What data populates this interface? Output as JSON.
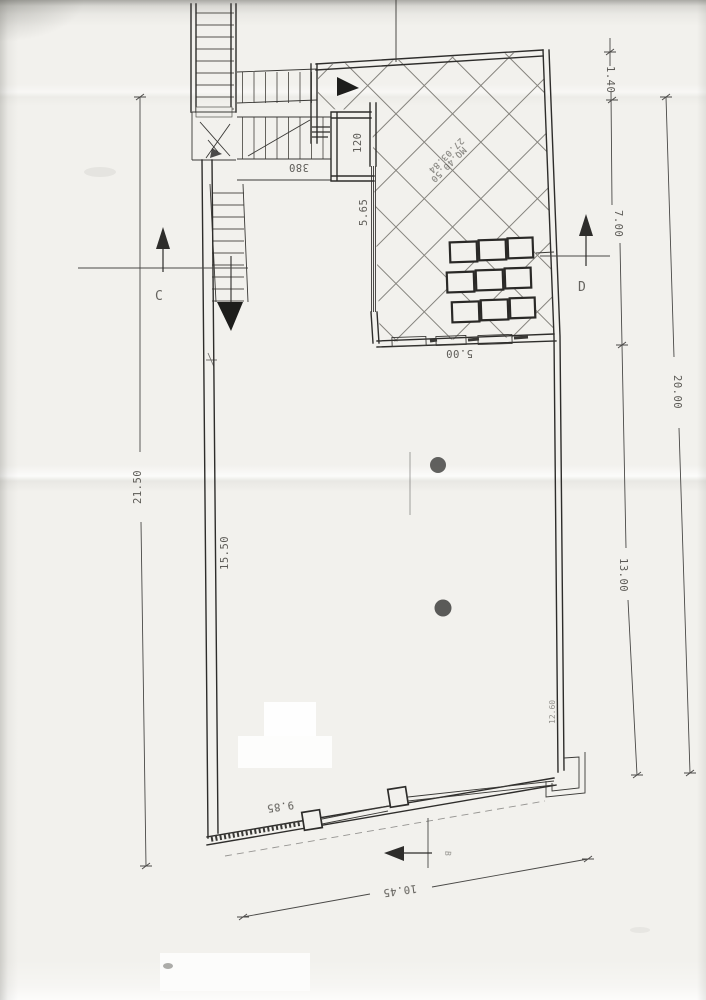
{
  "document": {
    "kind": "scanned floor plan",
    "dimensions": {
      "d21_50": "21.50",
      "d15_50": "15.50",
      "d1_40": "1.40",
      "d7_00": "7.00",
      "d20_00": "20.00",
      "d13_00": "13.00",
      "d5_00": "5.00",
      "d5_65": "5.65",
      "d120": "120",
      "d380": "380",
      "d9_85": "9.85",
      "d10_45": "10.45",
      "d12_60": "12.60"
    },
    "sections": {
      "c": "C",
      "d": "D",
      "b": "B"
    },
    "area_note": {
      "line1": "27.03.84",
      "line2": "MQ.40.50"
    },
    "colors": {
      "ink": "#2e2d2b",
      "dim_ink": "#4a4947",
      "paper": "#f2f1ed",
      "punch_hole": "#474644"
    }
  }
}
